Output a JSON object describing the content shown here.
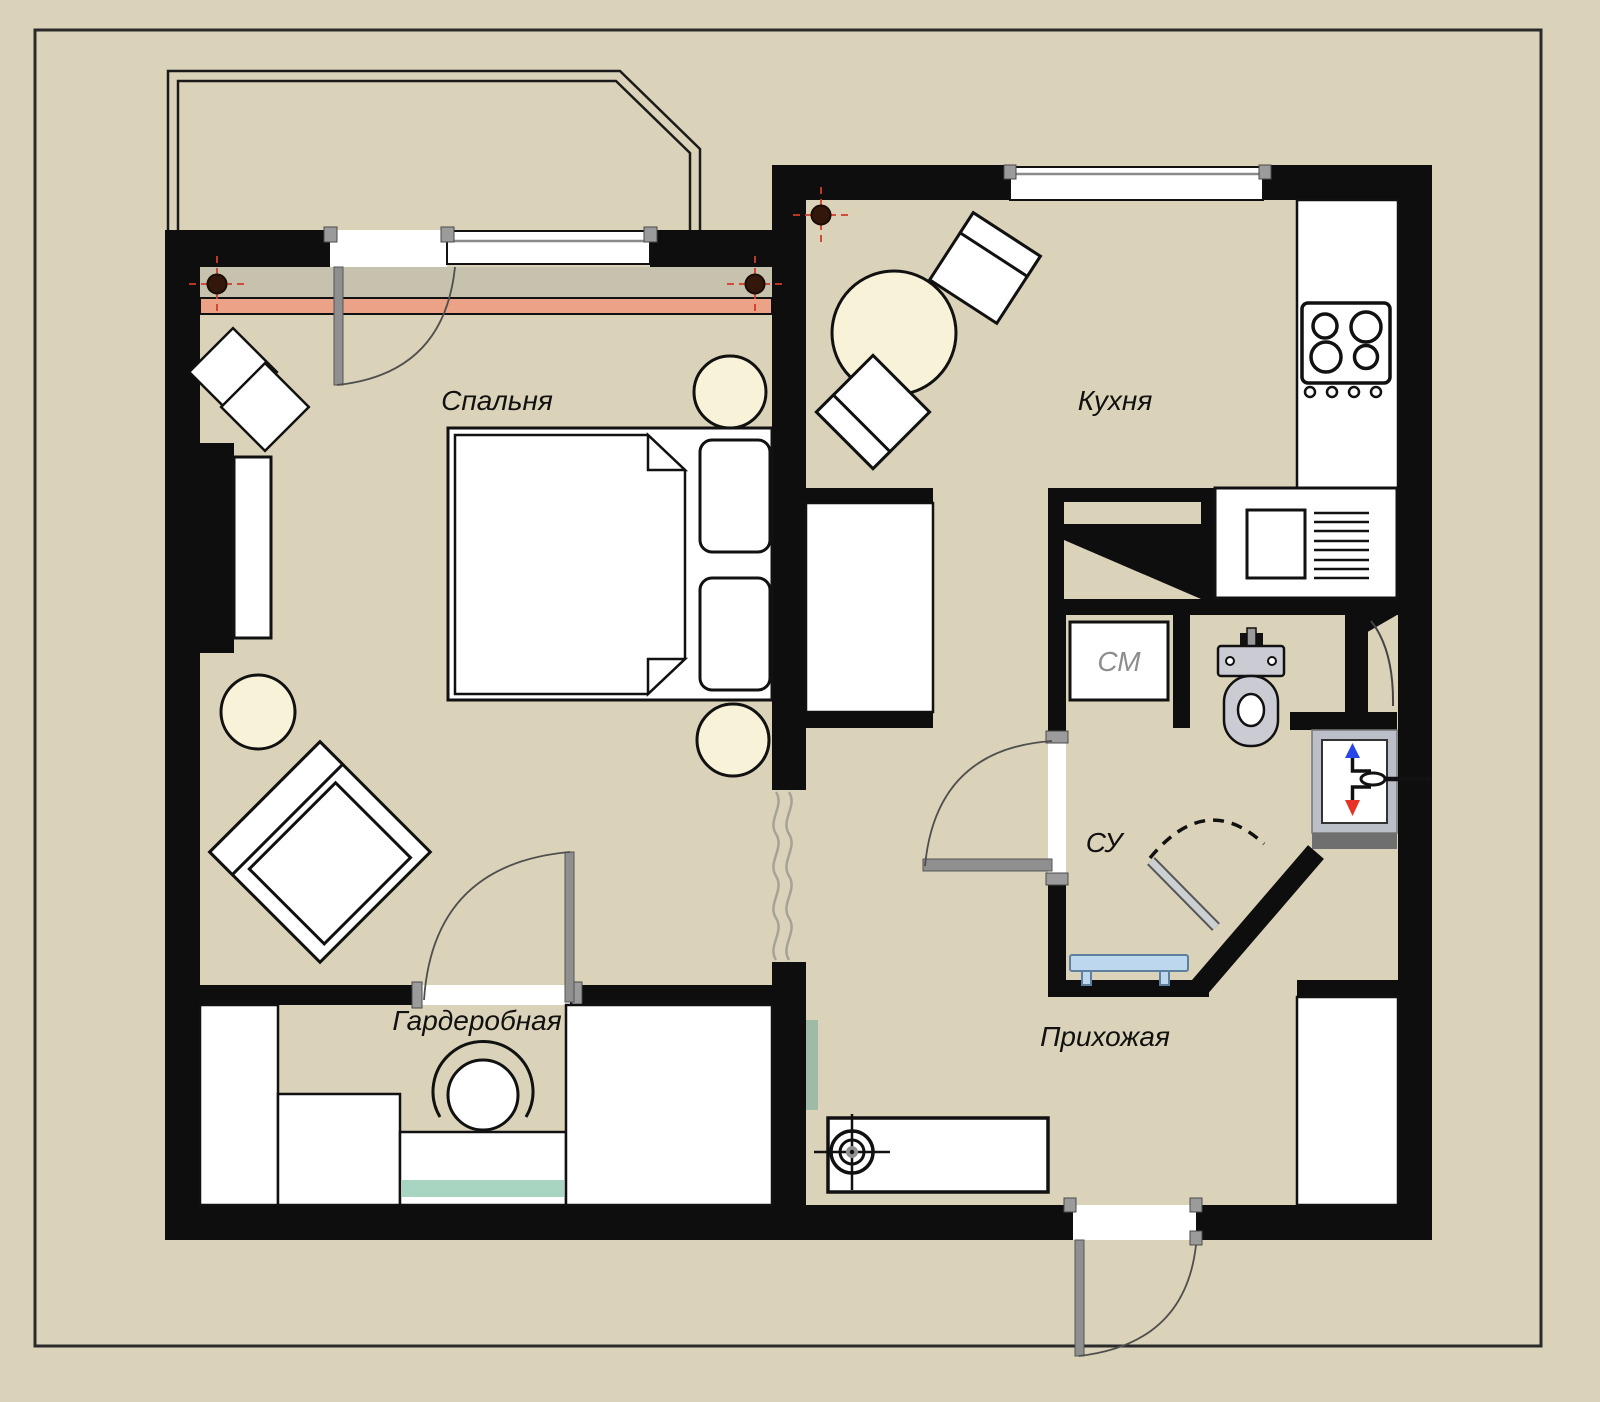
{
  "title": "Однокомнатная квартира — план",
  "rooms": {
    "bedroom": {
      "label": "Спальня"
    },
    "kitchen": {
      "label": "Кухня"
    },
    "wardrobe": {
      "label": "Гардеробная"
    },
    "hallway": {
      "label": "Прихожая"
    },
    "bathroom": {
      "label": "СУ"
    },
    "washing_machine": {
      "label": "СМ"
    }
  },
  "icons": {
    "supply_riser_arrow": "up-triangle",
    "return_riser_arrow": "down-triangle",
    "ceiling_light_point": "crosshair-circles",
    "heating_riser_point": "filled-circle-with-red-crosshair"
  },
  "colors": {
    "beige": "#DBD3B9",
    "wall": "#0E0E0E",
    "ink": "#111111",
    "cream": "#F8F2D9",
    "grayBand": "#C6C2AD",
    "salmon": "#ECA287",
    "teal": "#A8D4C2",
    "sage": "#9FBAA6",
    "benchBlue": "#BDD7EE",
    "benchEdge": "#5F7F9F",
    "riserFrame": "#BBBFC8",
    "darkStrip": "#6F6F6F",
    "leafGray": "#8F8F8F",
    "jambGray": "#9B9B9B",
    "arc": "#4F4F4F",
    "dashRed": "#D23B28",
    "dotBrown": "#33170A",
    "pipeBlue": "#2746E8",
    "pipeRed": "#E53425",
    "toiletGray": "#CBCCD3",
    "labelGray": "#8D8D8D",
    "squiggle": "#A5A296",
    "lineGray": "#8A8A8A",
    "border": "#2B2B2B"
  }
}
